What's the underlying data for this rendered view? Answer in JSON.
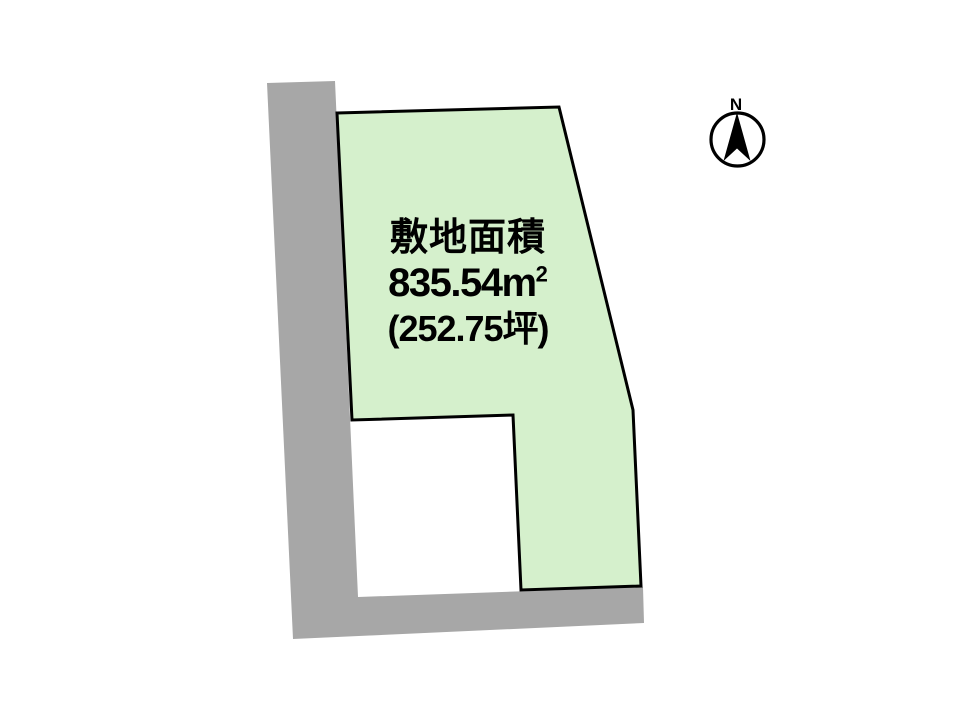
{
  "diagram": {
    "type": "land-plot-site-plan",
    "plot_label": {
      "title": "敷地面積",
      "area_sqm_value": "835.54",
      "area_sqm_unit": "m",
      "area_sqm_exponent": "2",
      "area_tsubo": "(252.75坪)"
    },
    "compass": {
      "north_label": "N"
    }
  },
  "colors": {
    "plot_fill": "#d5f0cc",
    "plot_stroke": "#000000",
    "road_fill": "#a7a7a7",
    "background": "#ffffff",
    "text": "#000000"
  }
}
